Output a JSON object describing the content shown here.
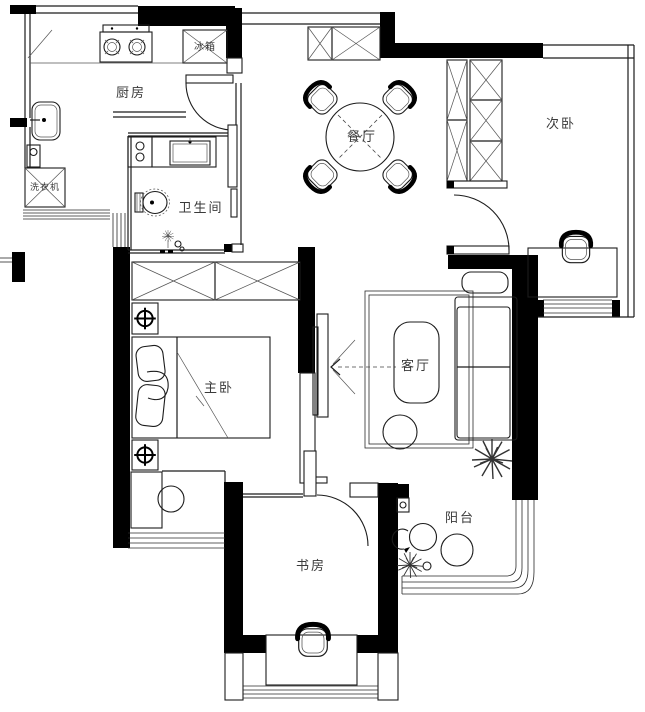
{
  "meta": {
    "type": "apartment-floor-plan"
  },
  "rooms": {
    "kitchen": {
      "label": "厨房"
    },
    "fridge": {
      "label": "冰箱"
    },
    "dining": {
      "label": "餐厅"
    },
    "second_bedroom": {
      "label": "次卧"
    },
    "washing_machine": {
      "label": "洗衣机"
    },
    "bathroom": {
      "label": "卫生间"
    },
    "master_bedroom": {
      "label": "主卧"
    },
    "living_room": {
      "label": "客厅"
    },
    "study": {
      "label": "书房"
    },
    "balcony": {
      "label": "阳台"
    }
  },
  "colors": {
    "wall": "#000000",
    "line": "#2a2a2a",
    "background": "#ffffff"
  }
}
